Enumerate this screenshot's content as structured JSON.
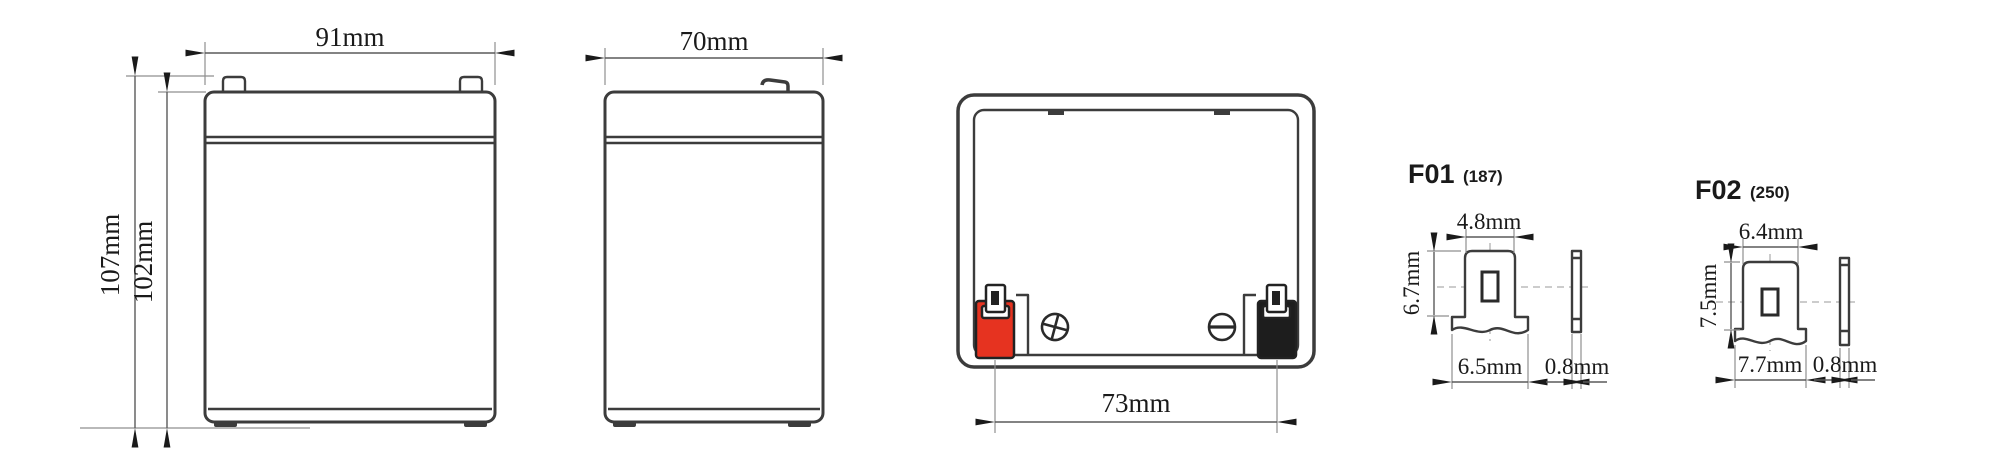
{
  "front_view": {
    "width_label": "91mm",
    "overall_height_label": "107mm",
    "case_height_label": "102mm"
  },
  "side_view": {
    "depth_label": "70mm"
  },
  "top_view": {
    "terminal_spacing_label": "73mm",
    "polarity_icons": [
      "plus-circle-icon",
      "minus-circle-icon"
    ]
  },
  "terminals": [
    {
      "name": "F01",
      "size_code": "(187)",
      "tab_width_label": "4.8mm",
      "tab_height_label": "6.7mm",
      "base_width_label": "6.5mm",
      "thickness_label": "0.8mm"
    },
    {
      "name": "F02",
      "size_code": "(250)",
      "tab_width_label": "6.4mm",
      "tab_height_label": "7.5mm",
      "base_width_label": "7.7mm",
      "thickness_label": "0.8mm"
    }
  ],
  "colors": {
    "positive": "#e63320",
    "negative": "#1d1d1d",
    "line": "#3c3c3c",
    "text": "#1a1a1a",
    "background": "#ffffff"
  }
}
